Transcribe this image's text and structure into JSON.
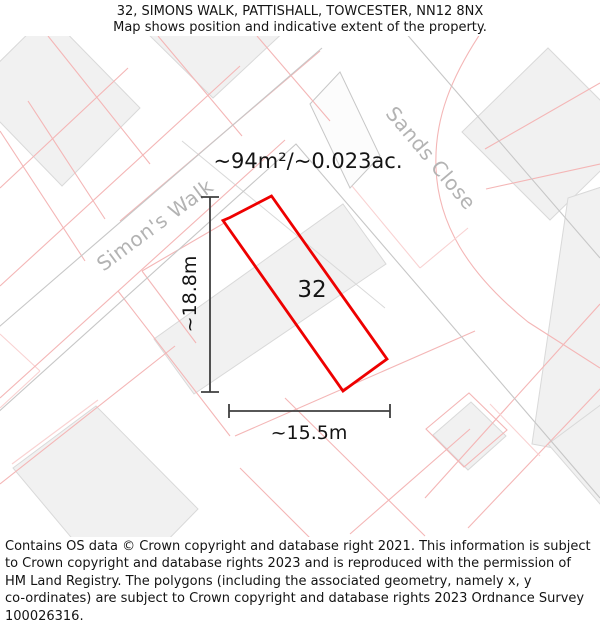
{
  "header": {
    "line1": "32, SIMONS WALK, PATTISHALL, TOWCESTER, NN12 8NX",
    "line2": "Map shows position and indicative extent of the property."
  },
  "map": {
    "area_label": "~94m²/~0.023ac.",
    "plot_number": "32",
    "height_label": "~18.8m",
    "width_label": "~15.5m",
    "street_names": {
      "simons_walk": "Simon's Walk",
      "sands_close": "Sands Close"
    }
  },
  "footer": {
    "lines": [
      "Contains OS data © Crown copyright and database right 2021. This information is subject",
      "to Crown copyright and database rights 2023 and is reproduced with the permission of",
      "HM Land Registry. The polygons (including the associated geometry, namely x, y",
      "co-ordinates) are subject to Crown copyright and database rights 2023 Ordnance Survey",
      "100026316."
    ]
  },
  "colors": {
    "property-outline": "#ee0000",
    "parcel-pink": "#f4b6b6",
    "parcel-pink-light": "#f9d2d2",
    "building-fill": "#f1f1f1",
    "building-stroke": "#d9d9d9",
    "road-edge": "#c7c7c7",
    "street-label": "#b3b3b3",
    "dimension-line": "#3f3f3f",
    "text": "#141414",
    "background": "#ffffff"
  }
}
